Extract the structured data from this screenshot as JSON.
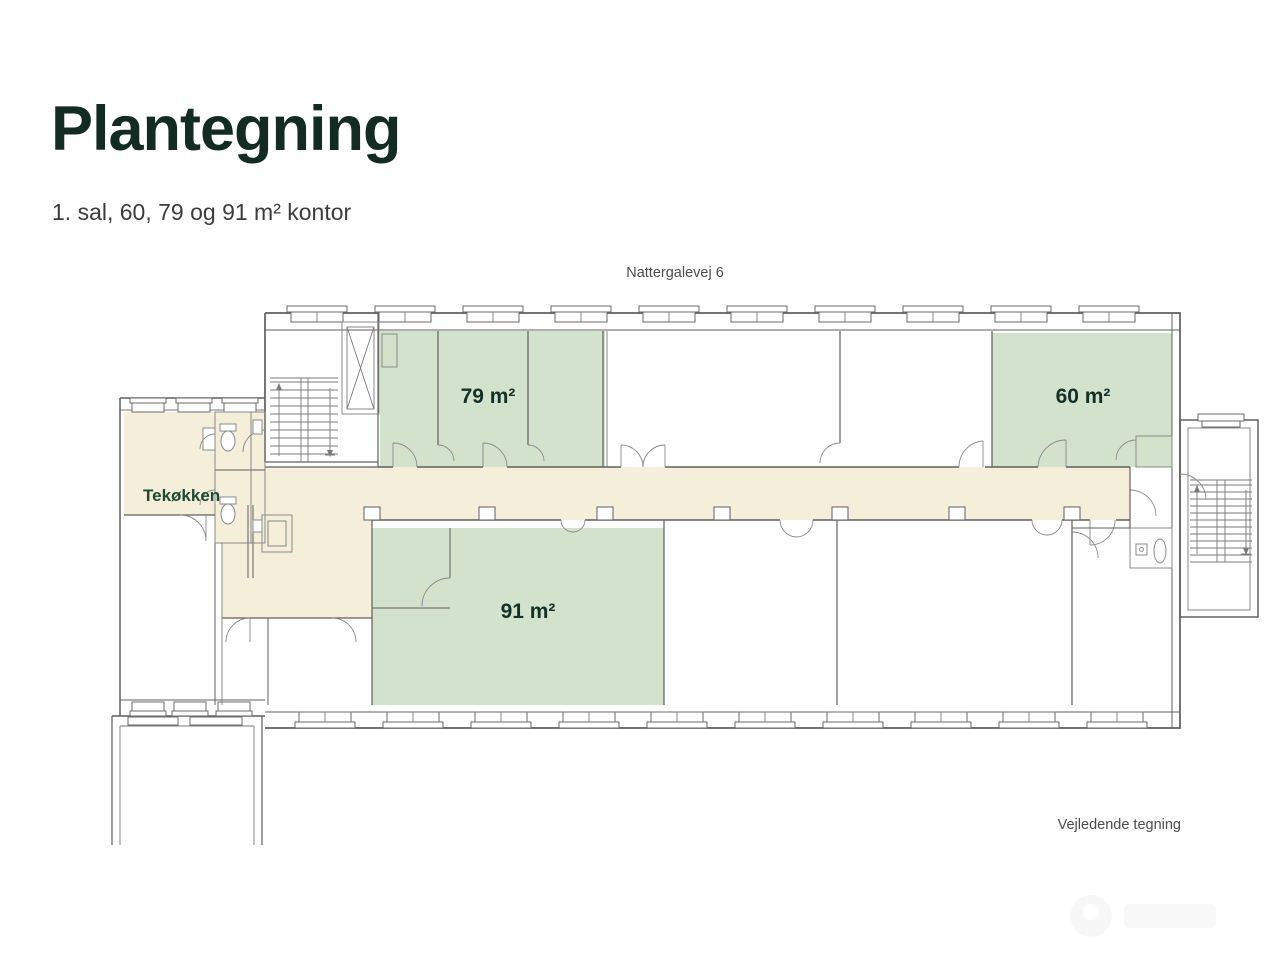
{
  "page": {
    "title": "Plantegning",
    "subtitle": "1. sal, 60, 79 og 91 m² kontor"
  },
  "plan": {
    "street_label": "Nattergalevej 6",
    "disclaimer": "Vejledende tegning",
    "kitchen_label": "Tekøkken",
    "rooms": [
      {
        "name": "kontor-79",
        "label": "79 m²",
        "area_m2": 79,
        "highlighted": true
      },
      {
        "name": "kontor-60",
        "label": "60 m²",
        "area_m2": 60,
        "highlighted": true
      },
      {
        "name": "kontor-91",
        "label": "91 m²",
        "area_m2": 91,
        "highlighted": true
      }
    ],
    "colors": {
      "highlight": "#d3e2cd",
      "circulation": "#f4eedb",
      "wall": "#5f5f5f",
      "room_label": "#153027",
      "kitchen_label": "#1c4a33",
      "annotation": "#4b4b4b"
    }
  },
  "header_colors": {
    "title": "#132b22",
    "subtitle": "#3b3b3b"
  }
}
